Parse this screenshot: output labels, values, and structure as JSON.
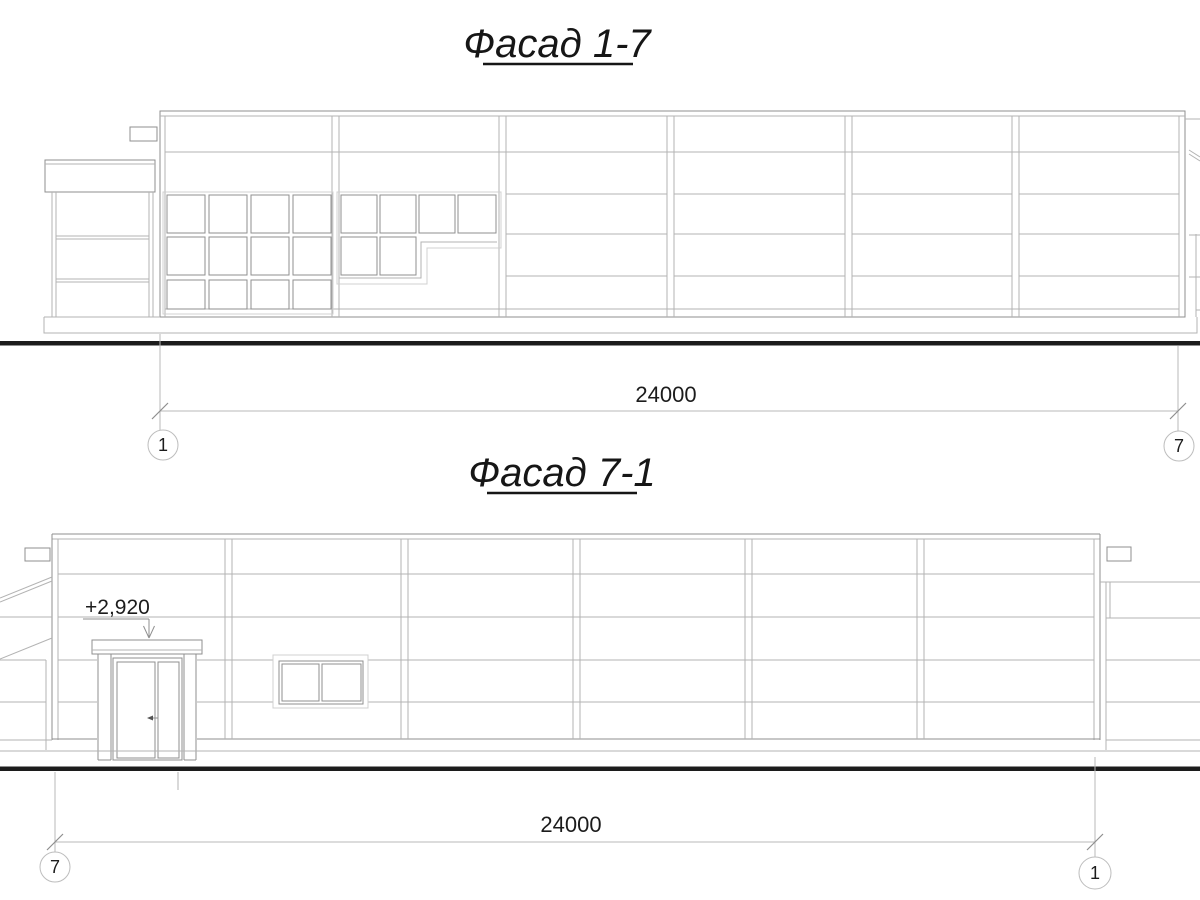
{
  "drawing": {
    "type_note": "two building facade elevations",
    "colors": {
      "background": "#ffffff",
      "thin_line": "#b3b3b3",
      "outline_line": "#8f8f8f",
      "ground_line": "#1c1c1c",
      "text": "#1c1c1c"
    }
  },
  "facade_top": {
    "title": "Фасад 1-7",
    "dimension": "24000",
    "axis_left": "1",
    "axis_right": "7"
  },
  "facade_bottom": {
    "title": "Фасад 7-1",
    "dimension": "24000",
    "axis_left": "7",
    "axis_right": "1",
    "elevation_mark": "+2,920"
  }
}
